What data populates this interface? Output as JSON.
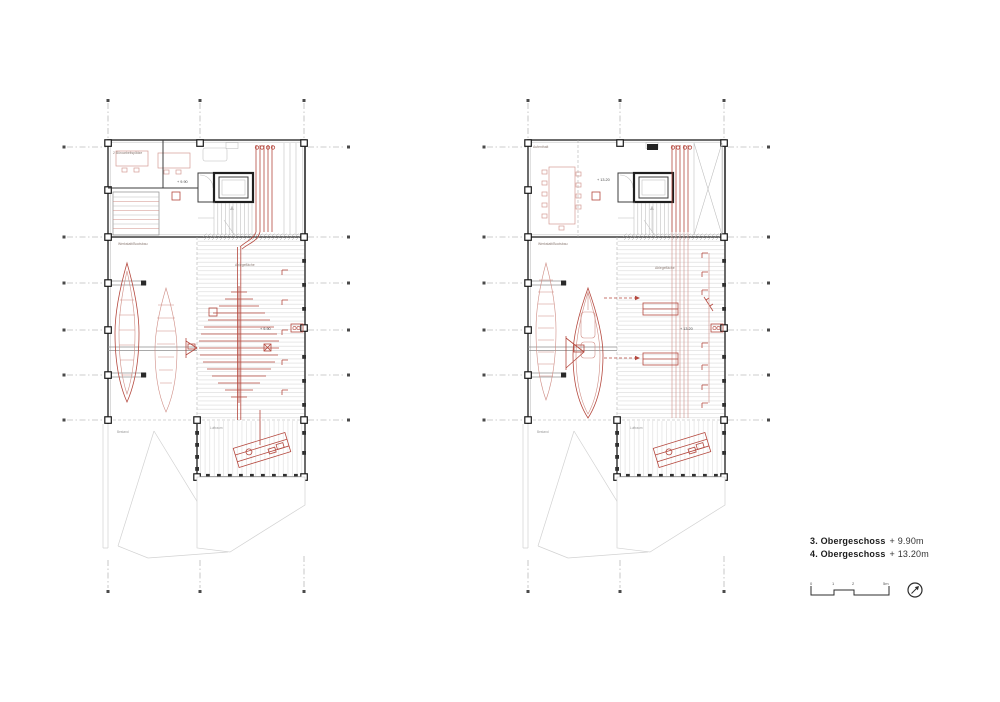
{
  "document": {
    "type": "Grundriss-Plan (Bootswerkstatt)",
    "floors_shown": "3. und 4. Obergeschoss"
  },
  "legend": {
    "floors": [
      {
        "name": "3. Obergeschoss",
        "level": "+ 9.90m"
      },
      {
        "name": "4. Obergeschoss",
        "level": "+ 13.20m"
      }
    ],
    "scale_ticks": [
      "0",
      "1",
      "2",
      "5m"
    ],
    "north_icon": "compass-north-arrow"
  },
  "plans": [
    {
      "title": "3. Obergeschoss",
      "level_marker": "+ 9.90",
      "labels": {
        "room_top": "2 Büroarbeitsplätze",
        "workshop": "Werkstatt/Bootsbau",
        "deck": "Ablegefläche",
        "void": "Luftraum",
        "below": "Bestand"
      }
    },
    {
      "title": "4. Obergeschoss",
      "level_marker": "+ 13.20",
      "labels": {
        "room_top": "Aufenthalt",
        "workshop": "Werkstatt/Bootsbau",
        "deck": "Ablegefläche",
        "void": "Luftraum",
        "below": "Bestand"
      }
    }
  ],
  "colors": {
    "accent_red": "#b5493f",
    "light_red": "#d49c94",
    "line_gray": "#c4c4c4",
    "wall_dark": "#3c3c3c"
  }
}
